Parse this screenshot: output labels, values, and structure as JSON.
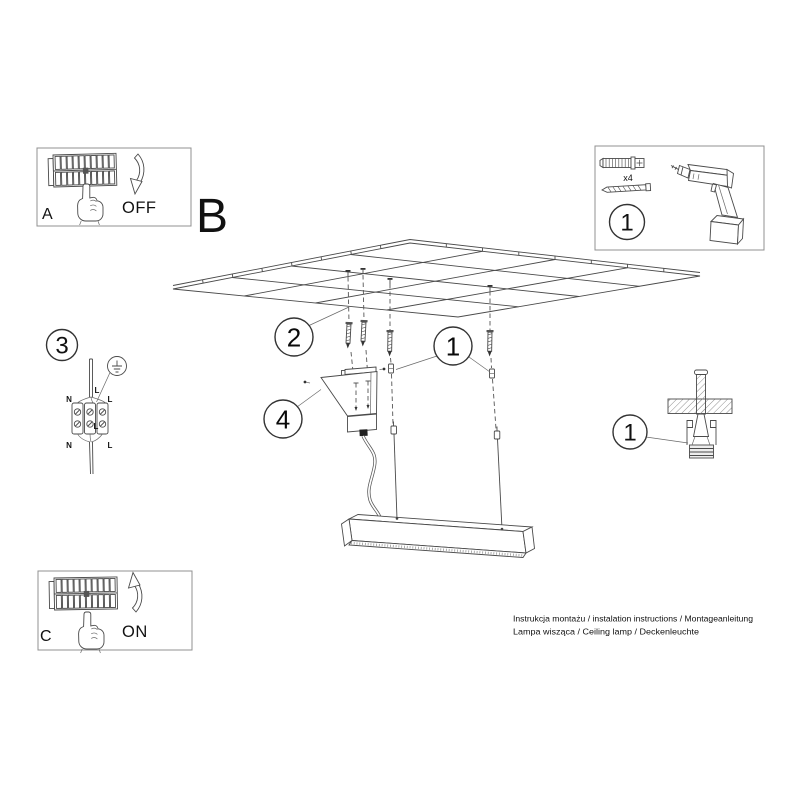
{
  "labels": {
    "step_a": "A",
    "step_b": "B",
    "step_c": "C",
    "off": "OFF",
    "on": "ON",
    "qty": "x4",
    "part_1_box": "1",
    "callout_screw_anchors": "2",
    "callout_suspension": "1",
    "callout_canopy": "4",
    "callout_wiring": "3",
    "callout_ceiling_detail": "1",
    "wiring": {
      "n_top": "N",
      "l_top": "L",
      "l_wire": "L",
      "l_inner": "L",
      "n_bottom": "N",
      "l_bottom": "L"
    }
  },
  "footer": {
    "line1": "Instrukcja montażu / instalation instructions / Montageanleitung",
    "line2": "Lampa wisząca / Ceiling lamp / Deckenleuchte"
  },
  "colors": {
    "background": "#ffffff",
    "line": "#4a4a4a",
    "text": "#111111",
    "box_border": "#909090"
  }
}
